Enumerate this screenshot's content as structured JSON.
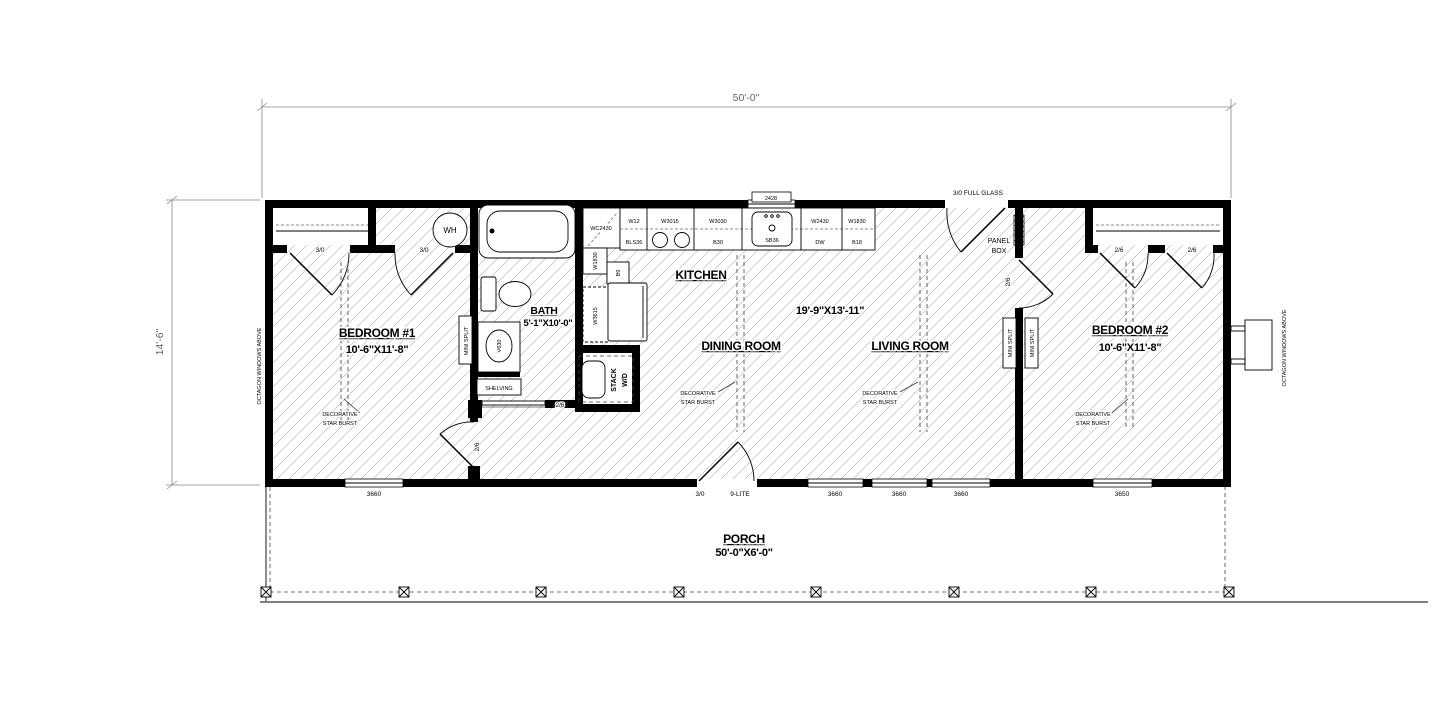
{
  "dimensions": {
    "overall_width": "50'-0\"",
    "overall_depth": "14'-6\""
  },
  "rooms": {
    "bedroom1": {
      "name": "BEDROOM #1",
      "size": "10'-6\"X11'-8\""
    },
    "bath": {
      "name": "BATH",
      "size": "5'-1\"X10'-0\""
    },
    "kitchen": {
      "name": "KITCHEN",
      "size": "19'-9\"X13'-11\""
    },
    "dining": {
      "name": "DINING ROOM"
    },
    "living": {
      "name": "LIVING ROOM"
    },
    "bedroom2": {
      "name": "BEDROOM #2",
      "size": "10'-6\"X11'-8\""
    },
    "porch": {
      "name": "PORCH",
      "size": "50'-0\"X6'-0\""
    }
  },
  "doors": {
    "bedroom1_closet": "3/0",
    "wh_closet": "3/0",
    "bedroom1_entry": "2/6",
    "bath_pocket": "2/6",
    "front_size": "3/0",
    "front_type": "9-LITE",
    "rear_full_glass": "3/0 FULL GLASS",
    "bedroom2_entry": "2/6",
    "bedroom2_closet_left": "2/6",
    "bedroom2_closet_right": "2/6"
  },
  "windows": {
    "kitchen_tag": "2428",
    "bedroom1": "3660",
    "living_1": "3660",
    "living_2": "3660",
    "living_3": "3660",
    "bedroom2": "3650"
  },
  "fixtures": {
    "water_heater": "WH",
    "vanity": "V630",
    "shelving": "SHELVING",
    "stack_wd_line1": "STACK",
    "stack_wd_line2": "W/D",
    "panel_box_line1": "PANEL",
    "panel_box_line2": "BOX",
    "mini_split": "MINI SPLIT"
  },
  "cabinets": {
    "corner": "WC2430",
    "w12": "W12",
    "bls36": "BLS36",
    "w3015": "W3015",
    "w3030": "W3030",
    "b30": "B30",
    "sink_base": "SB36",
    "w2430": "W2430",
    "dw": "DW",
    "w1830": "W1830",
    "b18": "B18",
    "left_wall": "W1830",
    "left_b9": "B9",
    "fridge_upper": "W3615"
  },
  "annotations": {
    "octagon_windows": "OCTAGON WINDOWS ABOVE",
    "decorative_line1": "DECORATIVE",
    "decorative_line2": "STAR BURST"
  }
}
